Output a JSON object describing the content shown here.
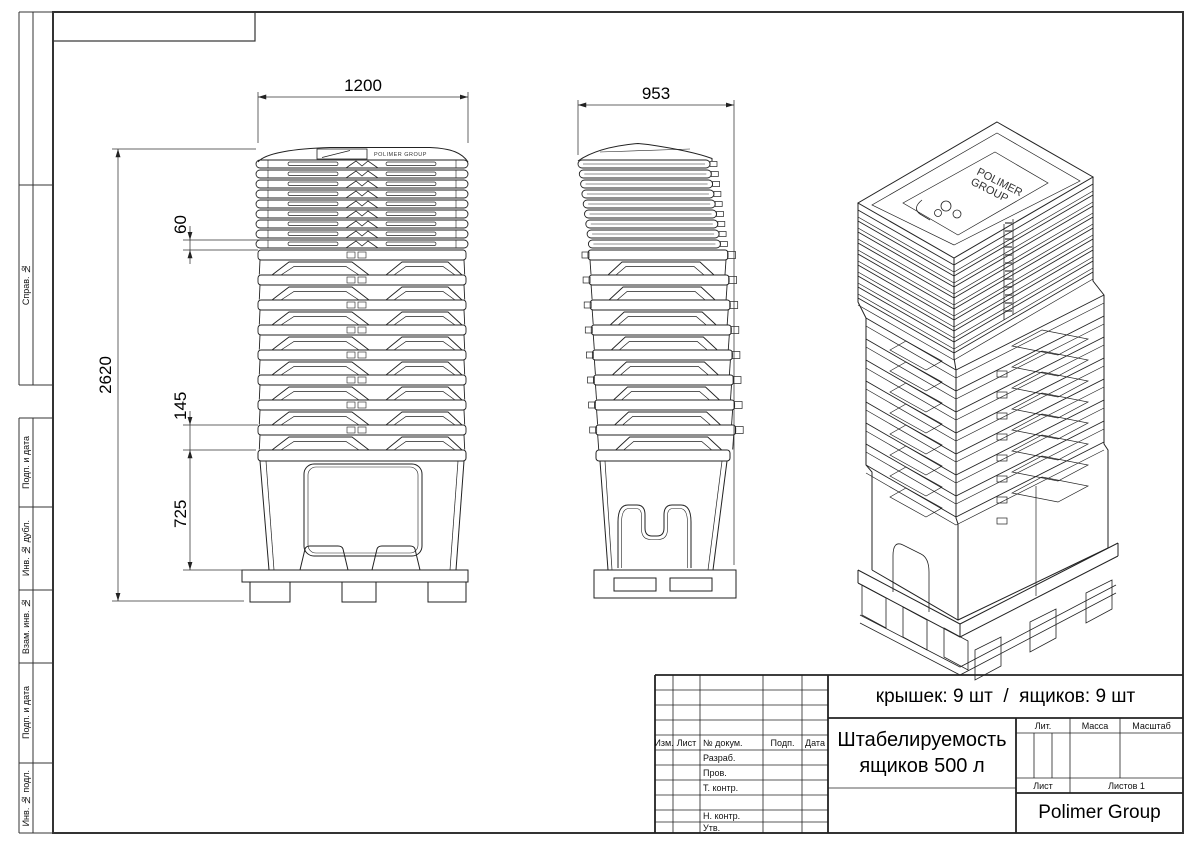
{
  "frame": {
    "side_labels": {
      "sprav": "Справ. №",
      "podp1": "Подп. и дата",
      "inv_dubl": "Инв. № дубл.",
      "vzam": "Взам. инв. №",
      "podp2": "Подп. и дата",
      "inv_podl": "Инв. № подл."
    }
  },
  "dims": {
    "front_width": "1200",
    "side_width": "953",
    "total_height": "2620",
    "lid_pitch": "60",
    "box_pitch": "145",
    "bottom_box_height": "725"
  },
  "brand": {
    "front_logo": "POLIMER GROUP",
    "iso_logo_line1": "POLIMER",
    "iso_logo_line2": "GROUP"
  },
  "title_block": {
    "counts": "крышек: 9 шт  /  ящиков: 9 шт",
    "doc_title_line1": "Штабелируемость",
    "doc_title_line2": "ящиков 500 л",
    "company": "Polimer Group",
    "col_izm": "Изм.",
    "col_list": "Лист",
    "col_doc": "№ докум.",
    "col_podp": "Подп.",
    "col_data": "Дата",
    "lit": "Лит.",
    "massa": "Масса",
    "masshtab": "Масштаб",
    "list_label": "Лист",
    "listov_label": "Листов 1",
    "row_razrab": "Разраб.",
    "row_prov": "Пров.",
    "row_tkontr": "Т. контр.",
    "row_nkontr": "Н. контр.",
    "row_utv": "Утв."
  }
}
